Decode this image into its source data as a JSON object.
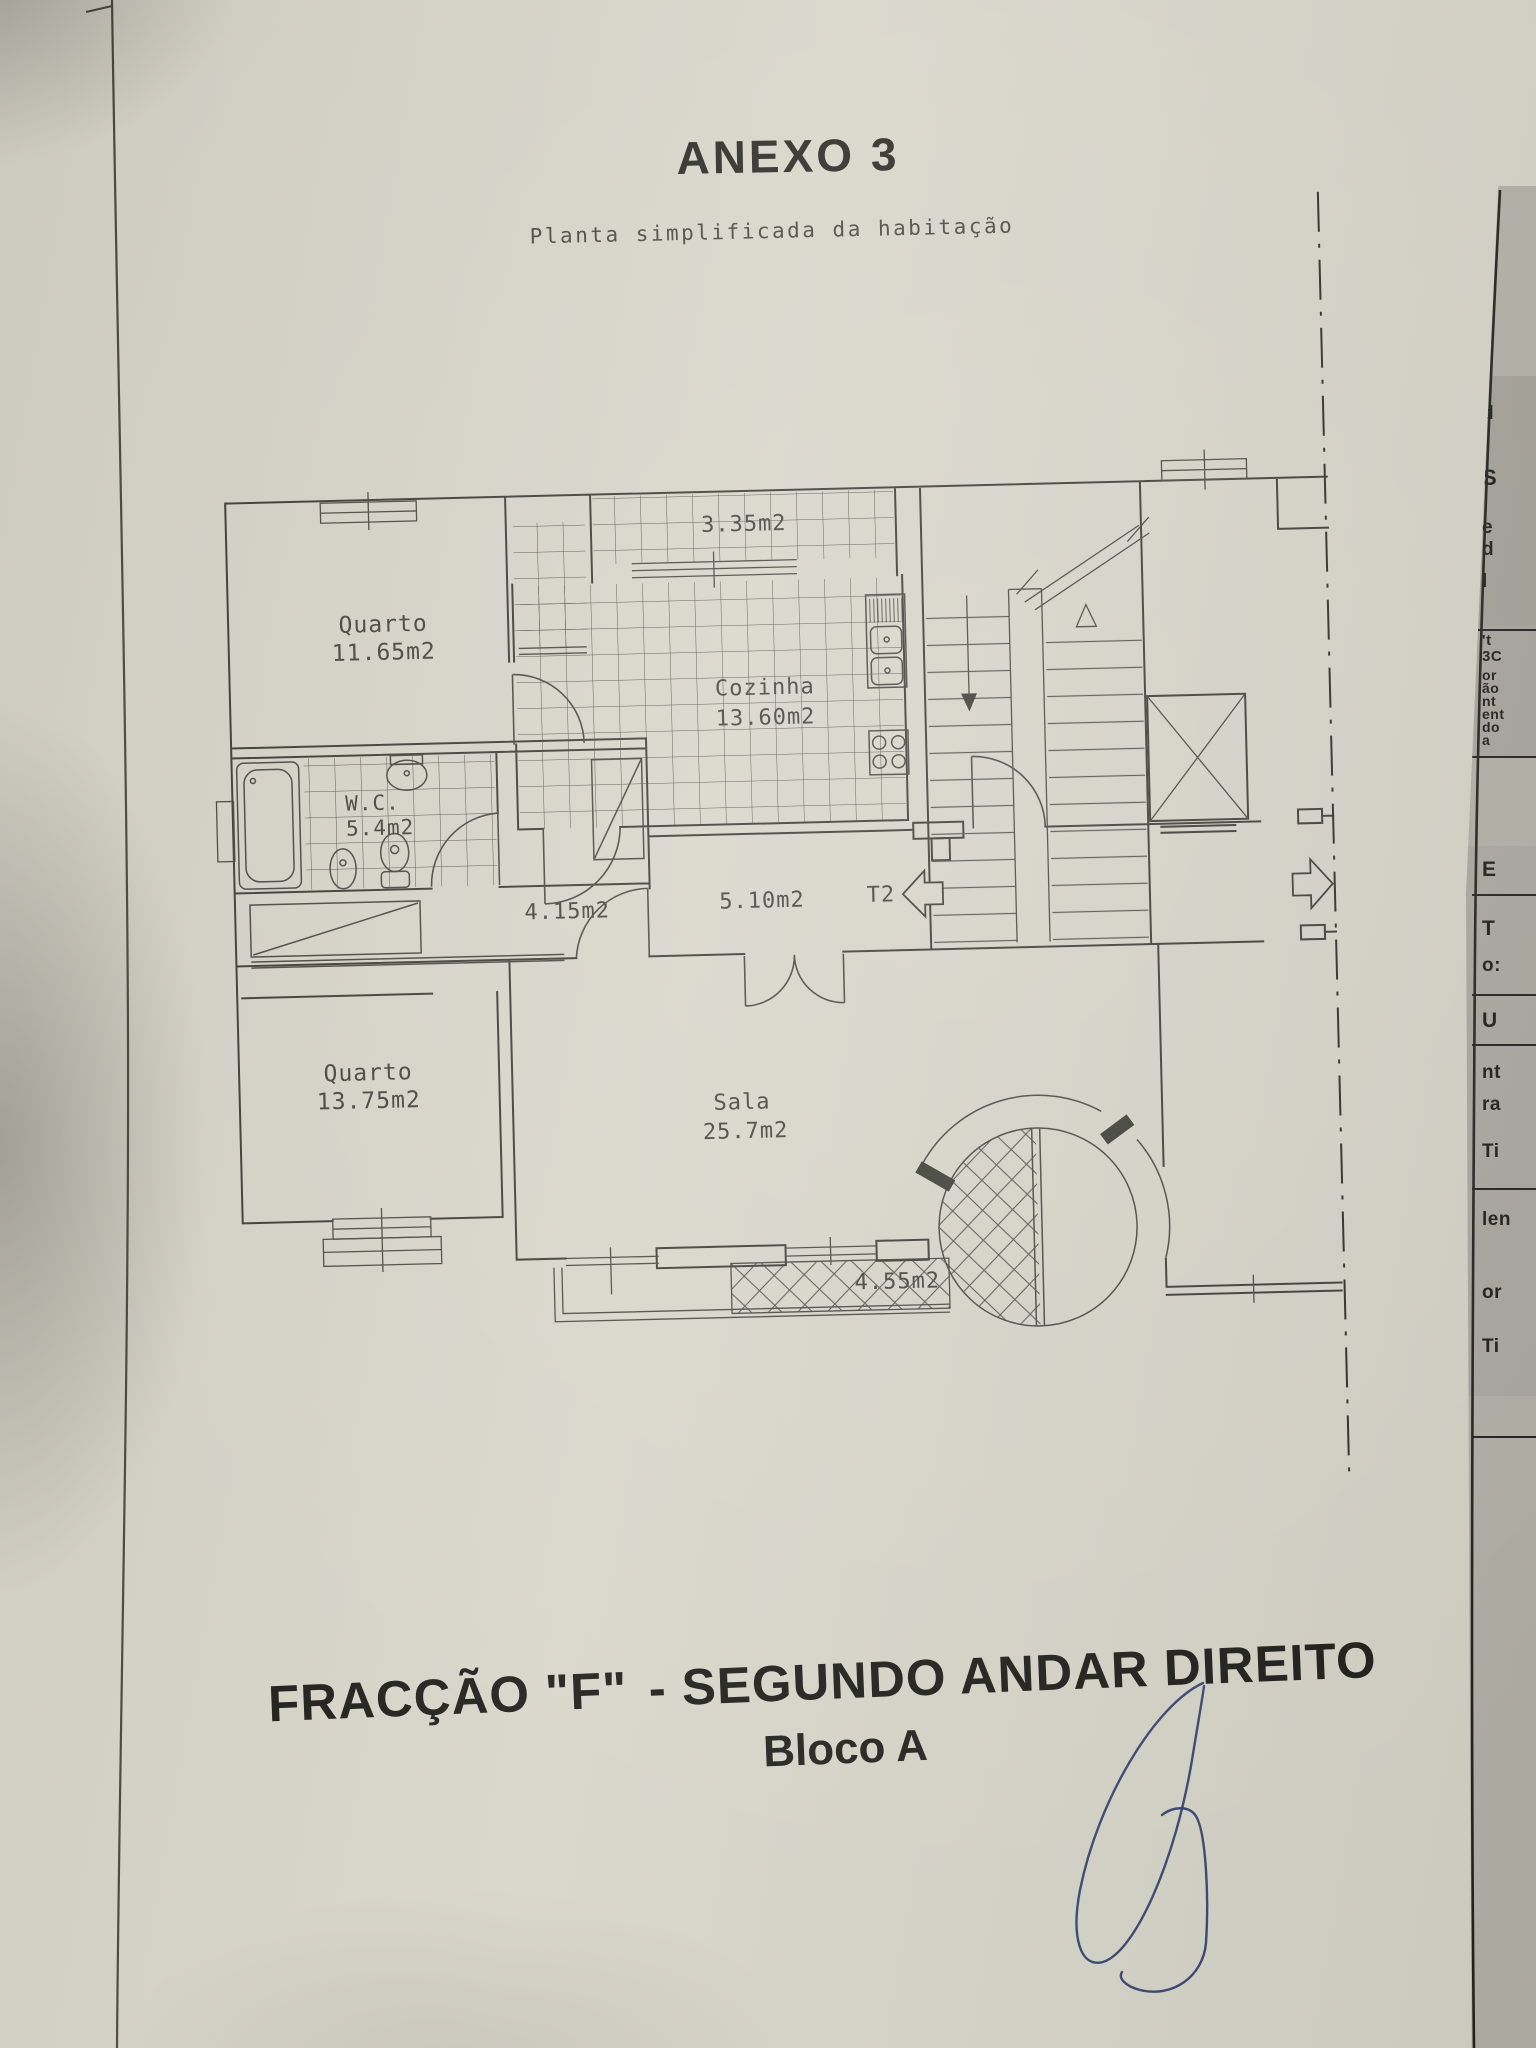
{
  "page": {
    "title": "ANEXO 3",
    "subtitle": "Planta simplificada da habitação",
    "caption_part1": "FRACÇÃO  \"F\"",
    "caption_part2": " - SEGUNDO ANDAR DIREITO",
    "caption_line2": "Bloco A"
  },
  "plan": {
    "rooms": {
      "quarto1": {
        "name": "Quarto",
        "area": "11.65m2"
      },
      "cozinha": {
        "name": "Cozinha",
        "area": "13.60m2"
      },
      "wc": {
        "name": "W.C.",
        "area": "5.4m2"
      },
      "quarto2": {
        "name": "Quarto",
        "area": "13.75m2"
      },
      "sala": {
        "name": "Sala",
        "area": "25.7m2"
      }
    },
    "labels": {
      "varanda_top": "3.35m2",
      "corredor": "4.15m2",
      "hall": "5.10m2",
      "tipologia": "T2",
      "varanda_sala": "4.55m2"
    }
  },
  "underlay": {
    "fragments": [
      {
        "t": "d"
      },
      {
        "t": "S"
      },
      {
        "t": "e"
      },
      {
        "t": "d"
      },
      {
        "t": "l"
      },
      {
        "t": "'t"
      },
      {
        "t": "3C"
      },
      {
        "t": "or"
      },
      {
        "t": "ão"
      },
      {
        "t": "nt"
      },
      {
        "t": "ent"
      },
      {
        "t": "do"
      },
      {
        "t": "a"
      },
      {
        "t": "E"
      },
      {
        "t": "T"
      },
      {
        "t": "o:"
      },
      {
        "t": "U"
      },
      {
        "t": "nt"
      },
      {
        "t": "ra"
      },
      {
        "t": "Ti"
      },
      {
        "t": "len"
      },
      {
        "t": "or"
      },
      {
        "t": "Ti"
      }
    ]
  },
  "colors": {
    "paper": "#d7d6ca",
    "ink": "#3e3e38",
    "underlay_paper": "#b4b3a9",
    "signature_ink": "#2c3a6b"
  }
}
